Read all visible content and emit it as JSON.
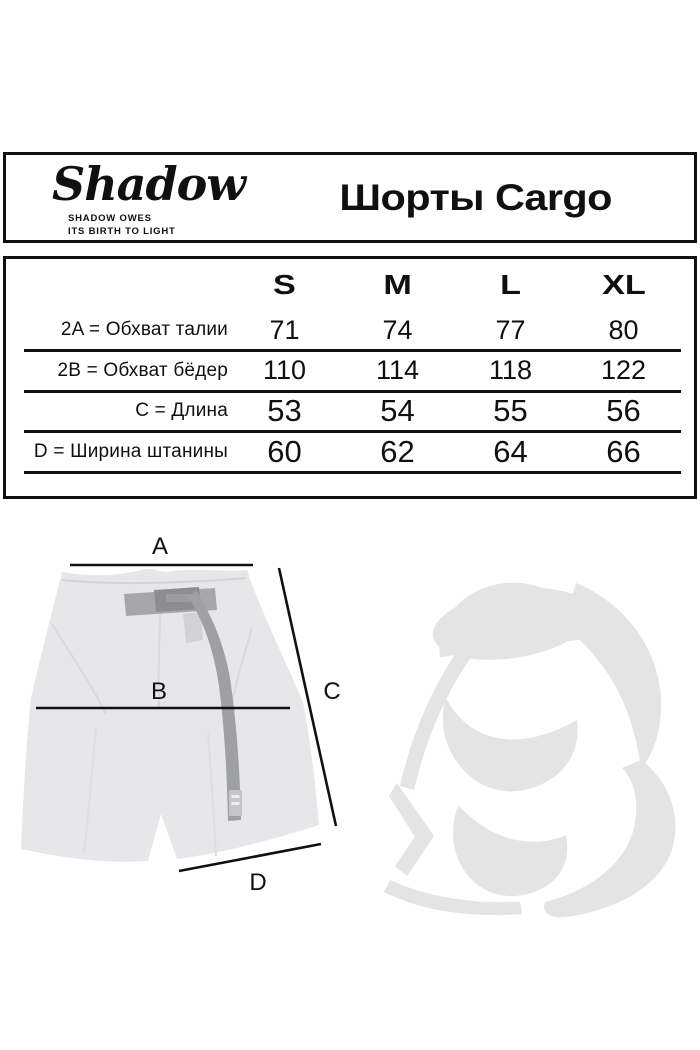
{
  "brand": {
    "logo_text": "Shadow",
    "tagline_line1": "SHADOW OWES",
    "tagline_line2": "ITS BIRTH TO LIGHT"
  },
  "header": {
    "title": "Шорты Cargo"
  },
  "sizes": {
    "columns": [
      "S",
      "M",
      "L",
      "XL"
    ],
    "rows": [
      {
        "label": "2A = Обхват талии",
        "values": [
          "71",
          "74",
          "77",
          "80"
        ]
      },
      {
        "label": "2B = Обхват бёдер",
        "values": [
          "110",
          "114",
          "118",
          "122"
        ]
      },
      {
        "label": "C = Длина",
        "values": [
          "53",
          "54",
          "55",
          "56"
        ]
      },
      {
        "label": "D = Ширина штанины",
        "values": [
          "60",
          "62",
          "64",
          "66"
        ]
      }
    ]
  },
  "diagram": {
    "labels": {
      "a": "A",
      "b": "B",
      "c": "C",
      "d": "D"
    }
  },
  "colors": {
    "ink": "#101010",
    "shorts_fill": "#e7e7e9",
    "belt_strap": "#9fa0a4",
    "belt_buckle": "#8d8d91",
    "watermark": "#e4e4e4"
  }
}
